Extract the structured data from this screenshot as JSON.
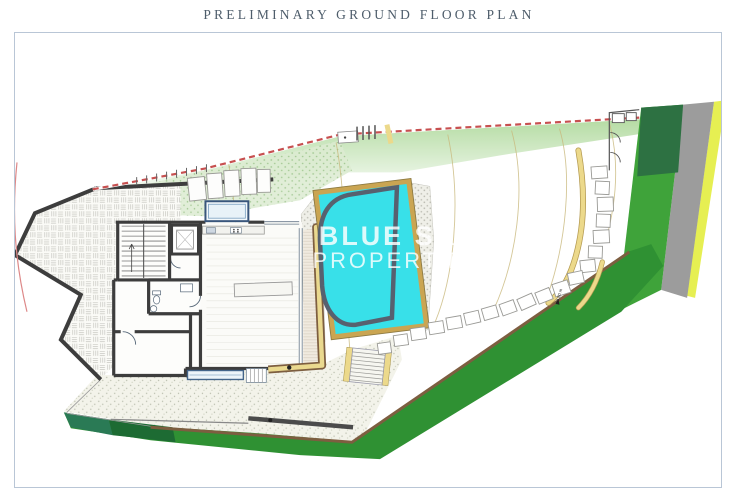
{
  "page": {
    "title": "PRELIMINARY GROUND FLOOR PLAN"
  },
  "watermark": {
    "line1": "BLUE SKY",
    "line2": "PROPERTIES"
  },
  "plan": {
    "level_annotation": "14.80 m"
  },
  "colors": {
    "title_text": "#4e5d6b",
    "frame_border": "#b9c6d6",
    "pool_water": "#38e0e9",
    "pool_border": "#57616f",
    "coping_yellow": "#dfbe63",
    "path_yellow": "#ecd98b",
    "hedge_green": "#2f9133",
    "hedge_dark_green": "#1d6b33",
    "hedge_teal": "#2a7a55",
    "band_green_bright": "#3fa33a",
    "band_green_dark": "#2d7142",
    "road_gray": "#9c9c9c",
    "verge_yellow": "#e6ef52",
    "deck_brown": "#7d5e40",
    "wall_dark": "#3d3d3d",
    "boundary_red": "#c75050",
    "grass_green": "#abd797",
    "contour_tan": "#c9b87c",
    "watermark_white": "rgba(255,255,255,0.82)"
  }
}
